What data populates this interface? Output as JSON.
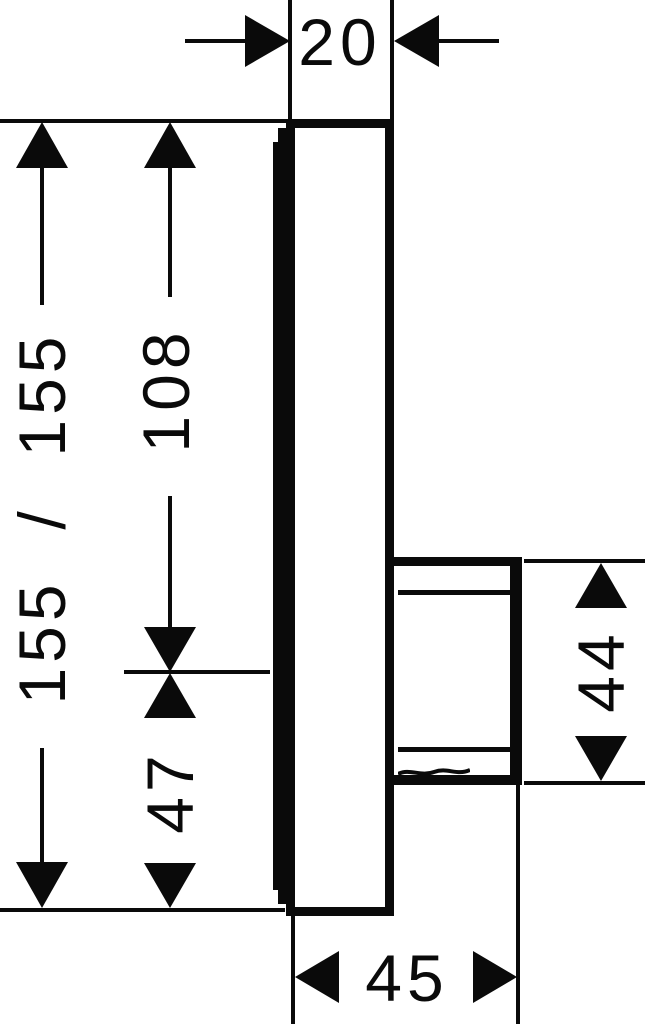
{
  "diagram": {
    "background": "#ffffff",
    "ink": "#0a0a0a",
    "type": "technical-dimension-drawing",
    "view": "side profile of concealed mixer faceplate with valve body",
    "dimensions": {
      "plate_thickness": "20",
      "plate_height": "155 / 155",
      "center_from_top": "108",
      "center_from_bottom": "47",
      "body_height": "44",
      "body_depth": "45"
    }
  }
}
